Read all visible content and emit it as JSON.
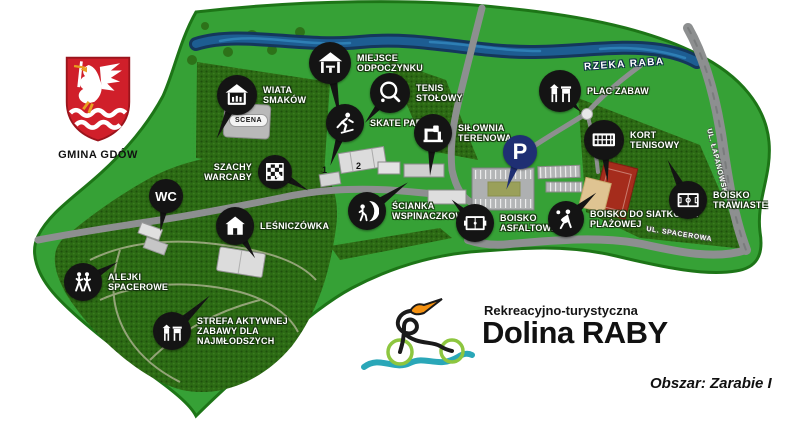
{
  "header": {
    "crest_label": "GMINA GDÓW"
  },
  "logo": {
    "subtitle": "Rekreacyjno-turystyczna",
    "title": "Dolina RABY",
    "area": "Obszar: Zarabie I"
  },
  "map_labels": {
    "river": "RZEKA RABA",
    "street_right": "UL. ŁAPANOWSKA",
    "street_bottom": "UL. SPACEROWA",
    "stage": "SCENA",
    "ramp_1": "1",
    "ramp_2": "2"
  },
  "colors": {
    "park_green": "#36a136",
    "forest_green": "#2c6a14",
    "river_blue": "#1d5d92",
    "road_gray": "#8d8f90",
    "marker_black": "#141414",
    "parking_navy": "#1f2f73",
    "court_red": "#a52c1c",
    "sand": "#dfc492",
    "crest_red": "#d01f2a",
    "logo_wheel_green": "#8dc63f",
    "logo_wave_teal": "#2aa7b8",
    "logo_flag_orange": "#f49111"
  },
  "pois": [
    {
      "id": "miejsce-odpoczynku",
      "icon": "shelter-icon",
      "label": "MIEJSCE\nODPOCZYNKU",
      "x": 330,
      "y": 63,
      "r": 21,
      "tail": {
        "angle": -10,
        "len": 58
      }
    },
    {
      "id": "wiata-smakow",
      "icon": "hut-icon",
      "label": "WIATA\nSMAKÓW",
      "x": 237,
      "y": 95,
      "r": 20,
      "tail": {
        "angle": 25,
        "len": 48
      }
    },
    {
      "id": "tenis-stolowy",
      "icon": "paddle-icon",
      "label": "TENIS\nSTOŁOWY",
      "x": 390,
      "y": 93,
      "r": 20,
      "tail": {
        "angle": 40,
        "len": 39
      }
    },
    {
      "id": "plac-zabaw",
      "icon": "playground-icon",
      "label": "PLAC ZABAW",
      "x": 560,
      "y": 91,
      "r": 21,
      "tail": {
        "angle": -45,
        "len": 30
      }
    },
    {
      "id": "skate-park",
      "icon": "skater-icon",
      "label": "SKATE PARK",
      "x": 345,
      "y": 123,
      "r": 19,
      "tail": {
        "angle": 19,
        "len": 45
      }
    },
    {
      "id": "silownia-terenowa",
      "icon": "gym-icon",
      "label": "SIŁOWNIA\nTERENOWA",
      "x": 433,
      "y": 133,
      "r": 19,
      "tail": {
        "angle": 4,
        "len": 43
      }
    },
    {
      "id": "kort-tenisowy",
      "icon": "tennis-net-icon",
      "label": "KORT\nTENISOWY",
      "x": 604,
      "y": 140,
      "r": 20,
      "tail": {
        "angle": -5,
        "len": 42
      }
    },
    {
      "id": "parking",
      "icon": "parking-letter-icon",
      "text": "P",
      "text_size": 22,
      "color": "#1f2f73",
      "label": "",
      "x": 520,
      "y": 152,
      "r": 17,
      "tail": {
        "angle": 20,
        "len": 40
      }
    },
    {
      "id": "szachy-warcaby",
      "icon": "chess-icon",
      "label": "SZACHY\nWARCABY",
      "label_side": "left",
      "x": 275,
      "y": 172,
      "r": 17,
      "tail": {
        "angle": -61,
        "len": 38
      }
    },
    {
      "id": "wc",
      "icon": "wc-letters-icon",
      "text": "WC",
      "text_size": 13,
      "label": "",
      "x": 166,
      "y": 196,
      "r": 17,
      "tail": {
        "angle": 9,
        "len": 36
      }
    },
    {
      "id": "scianka-wspinaczkowa",
      "icon": "climber-icon",
      "label": "ŚCIANKA\nWSPINACZKOWA",
      "x": 367,
      "y": 211,
      "r": 19,
      "tail": {
        "angle": -125,
        "len": 50
      }
    },
    {
      "id": "boisko-asfaltowe",
      "icon": "court-icon",
      "label": "BOISKO\nASFALTOWE",
      "x": 475,
      "y": 223,
      "r": 19,
      "tail": {
        "angle": 135,
        "len": 33
      }
    },
    {
      "id": "boisko-siatkowka-plazowa",
      "icon": "volleyball-icon",
      "label": "BOISKO DO SIATKÓWKI\nPLAŻOWEJ",
      "x": 566,
      "y": 219,
      "r": 18,
      "tail": {
        "angle": -131,
        "len": 40
      }
    },
    {
      "id": "boisko-trawiaste",
      "icon": "soccer-field-icon",
      "label": "BOISKO\nTRAWIASTE",
      "x": 688,
      "y": 200,
      "r": 19,
      "tail": {
        "angle": 153,
        "len": 45
      }
    },
    {
      "id": "lesniczowka",
      "icon": "house-icon",
      "label": "LEŚNICZÓWKA",
      "x": 235,
      "y": 226,
      "r": 19,
      "tail": {
        "angle": -32,
        "len": 38
      }
    },
    {
      "id": "alejki-spacerowe",
      "icon": "walkers-icon",
      "label": "ALEJKI\nSPACEROWE",
      "x": 83,
      "y": 282,
      "r": 19,
      "tail": {
        "angle": -120,
        "len": 40
      }
    },
    {
      "id": "strefa-najmlodszych",
      "icon": "playground-icon",
      "label": "STREFA AKTYWNEJ\nZABAWY DLA\nNAJMŁODSZYCH",
      "x": 172,
      "y": 331,
      "r": 19,
      "tail": {
        "angle": -133,
        "len": 52
      }
    }
  ]
}
